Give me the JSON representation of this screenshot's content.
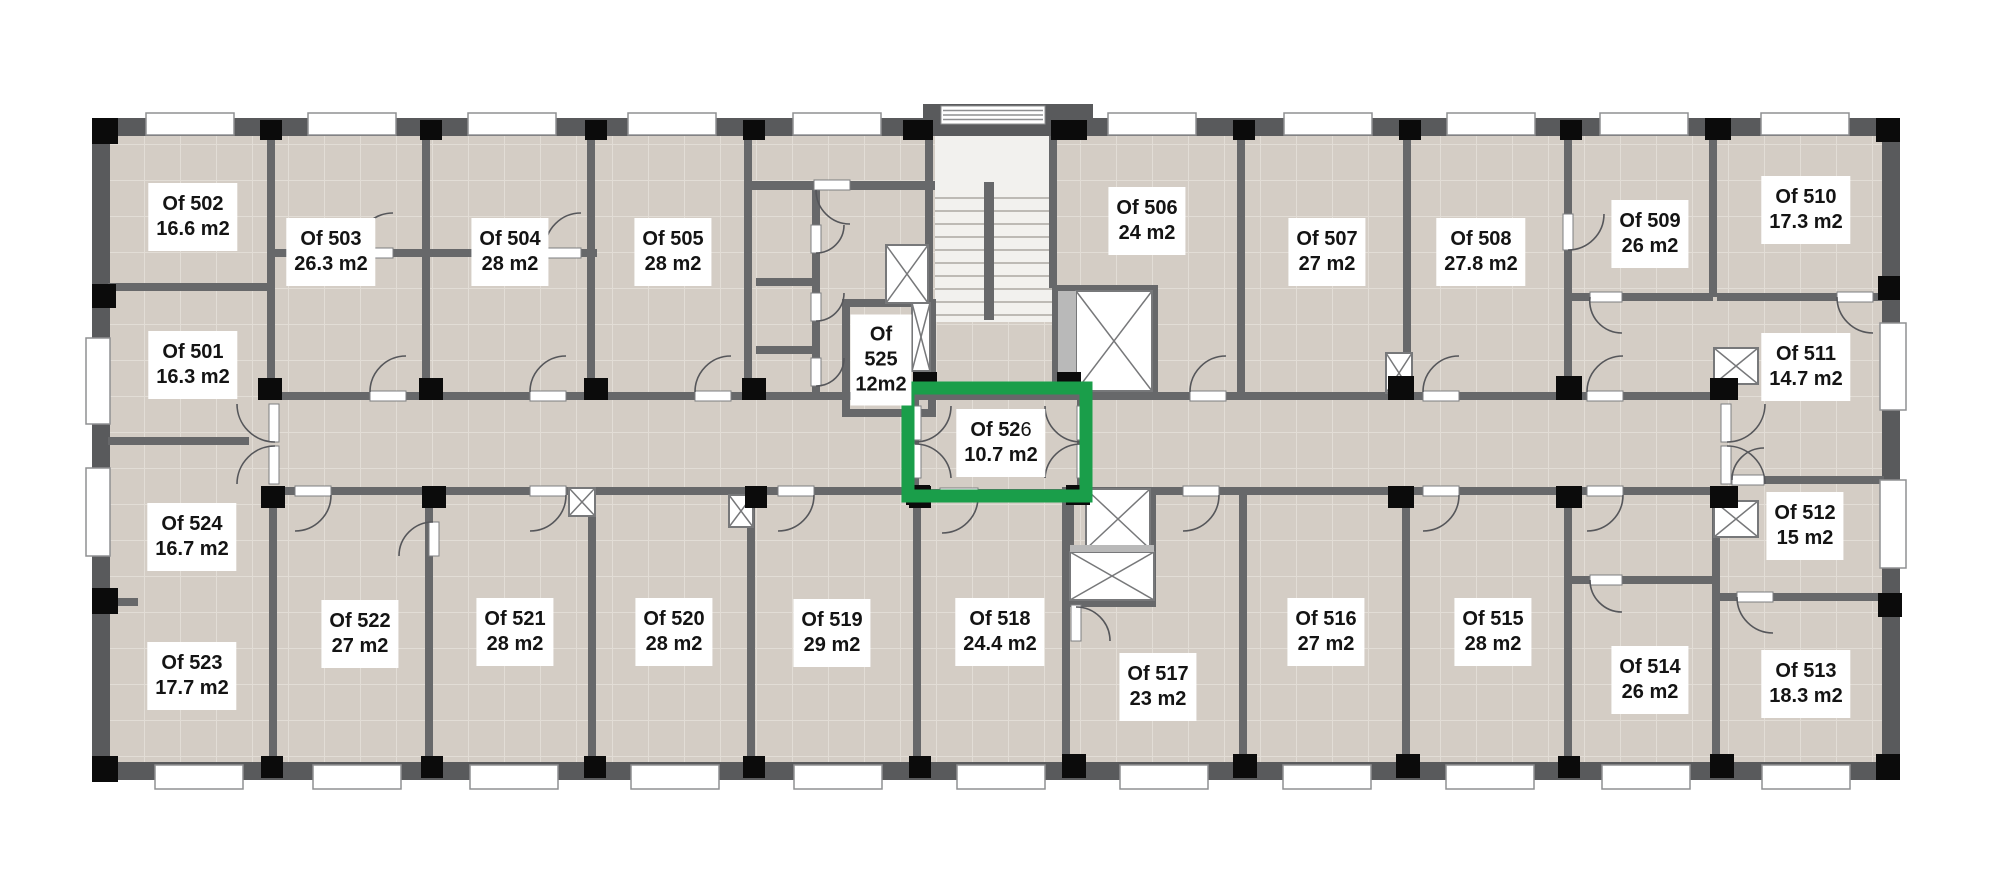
{
  "plan_title": "office-floor-plan",
  "colors": {
    "page_bg": "#ffffff",
    "floor_base": "#d4cdc5",
    "floor_grout": "#e2ddd6",
    "wall": "#67686a",
    "wall_dark": "#595a5c",
    "column": "#0b0b0b",
    "window_fill": "#ffffff",
    "window_border": "#8f9092",
    "door_arc": "#55565a",
    "leaf_border": "#7d7e80",
    "shaft_fill": "#ffffff",
    "shaft_border": "#77787a",
    "elevator_band": "#b9b9b9",
    "marble": "#f2f1ee",
    "step_line": "#bdbab5",
    "highlight_green": "#1a9e4a",
    "label_bg": "#ffffff",
    "label_text": "#141414"
  },
  "rooms": [
    {
      "id": "501",
      "label": "Of 501",
      "area": "16.3 m2",
      "cx": 193,
      "cy": 365
    },
    {
      "id": "502",
      "label": "Of 502",
      "area": "16.6 m2",
      "cx": 193,
      "cy": 217
    },
    {
      "id": "503",
      "label": "Of 503",
      "area": "26.3 m2",
      "cx": 331,
      "cy": 252
    },
    {
      "id": "504",
      "label": "Of 504",
      "area": "28 m2",
      "cx": 510,
      "cy": 252
    },
    {
      "id": "505",
      "label": "Of 505",
      "area": "28 m2",
      "cx": 673,
      "cy": 252
    },
    {
      "id": "506",
      "label": "Of 506",
      "area": "24 m2",
      "cx": 1147,
      "cy": 221
    },
    {
      "id": "507",
      "label": "Of 507",
      "area": "27 m2",
      "cx": 1327,
      "cy": 252
    },
    {
      "id": "508",
      "label": "Of 508",
      "area": "27.8 m2",
      "cx": 1481,
      "cy": 252
    },
    {
      "id": "509",
      "label": "Of 509",
      "area": "26 m2",
      "cx": 1650,
      "cy": 234
    },
    {
      "id": "510",
      "label": "Of 510",
      "area": "17.3 m2",
      "cx": 1806,
      "cy": 210
    },
    {
      "id": "511",
      "label": "Of 511",
      "area": "14.7 m2",
      "cx": 1806,
      "cy": 367
    },
    {
      "id": "512",
      "label": "Of 512",
      "area": "15 m2",
      "cx": 1805,
      "cy": 526
    },
    {
      "id": "513",
      "label": "Of 513",
      "area": "18.3 m2",
      "cx": 1806,
      "cy": 684
    },
    {
      "id": "514",
      "label": "Of 514",
      "area": "26 m2",
      "cx": 1650,
      "cy": 680
    },
    {
      "id": "515",
      "label": "Of 515",
      "area": "28 m2",
      "cx": 1493,
      "cy": 632
    },
    {
      "id": "516",
      "label": "Of 516",
      "area": "27 m2",
      "cx": 1326,
      "cy": 632
    },
    {
      "id": "517",
      "label": "Of 517",
      "area": "23 m2",
      "cx": 1158,
      "cy": 687
    },
    {
      "id": "518",
      "label": "Of 518",
      "area": "24.4 m2",
      "cx": 1000,
      "cy": 632
    },
    {
      "id": "519",
      "label": "Of 519",
      "area": "29 m2",
      "cx": 832,
      "cy": 633
    },
    {
      "id": "520",
      "label": "Of 520",
      "area": "28 m2",
      "cx": 674,
      "cy": 632
    },
    {
      "id": "521",
      "label": "Of 521",
      "area": "28 m2",
      "cx": 515,
      "cy": 632
    },
    {
      "id": "522",
      "label": "Of 522",
      "area": "27 m2",
      "cx": 360,
      "cy": 634
    },
    {
      "id": "523",
      "label": "Of 523",
      "area": "17.7 m2",
      "cx": 192,
      "cy": 676
    },
    {
      "id": "524",
      "label": "Of 524",
      "area": "16.7 m2",
      "cx": 192,
      "cy": 537
    },
    {
      "id": "525",
      "stacked": [
        "Of",
        "525",
        "12m2"
      ],
      "cx": 881,
      "cy": 360
    },
    {
      "id": "526",
      "label_bold": "Of 52",
      "label_tail": "6",
      "area": "10.7 m2",
      "cx": 1001,
      "cy": 443,
      "highlighted": true
    }
  ],
  "highlight": {
    "room_id": "526",
    "frame": [
      908,
      388,
      178,
      108
    ],
    "stroke_width": 13,
    "color": "#1a9e4a"
  },
  "geometry": {
    "floor": [
      110,
      136,
      1772,
      628
    ],
    "tile_size": 36,
    "exterior_walls": [
      [
        92,
        118,
        1808,
        18
      ],
      [
        92,
        762,
        1808,
        18
      ],
      [
        92,
        118,
        18,
        662
      ],
      [
        1882,
        118,
        18,
        662
      ],
      [
        923,
        104,
        170,
        22
      ]
    ],
    "interior_walls": [
      [
        267,
        136,
        8,
        260
      ],
      [
        422,
        136,
        8,
        260
      ],
      [
        587,
        136,
        8,
        260
      ],
      [
        744,
        136,
        8,
        260
      ],
      [
        925,
        136,
        8,
        172
      ],
      [
        1049,
        136,
        8,
        152
      ],
      [
        1237,
        136,
        8,
        260
      ],
      [
        1403,
        136,
        8,
        260
      ],
      [
        1564,
        136,
        8,
        260
      ],
      [
        1709,
        136,
        8,
        161
      ],
      [
        269,
        487,
        8,
        275
      ],
      [
        425,
        487,
        8,
        275
      ],
      [
        588,
        487,
        8,
        275
      ],
      [
        747,
        487,
        8,
        275
      ],
      [
        913,
        487,
        8,
        275
      ],
      [
        1062,
        487,
        8,
        275
      ],
      [
        1239,
        487,
        8,
        275
      ],
      [
        1402,
        487,
        8,
        275
      ],
      [
        1564,
        487,
        8,
        275
      ],
      [
        1712,
        487,
        8,
        275
      ],
      [
        108,
        283,
        163,
        8
      ],
      [
        108,
        437,
        141,
        8
      ],
      [
        108,
        598,
        30,
        8
      ],
      [
        275,
        249,
        322,
        8
      ],
      [
        275,
        392,
        636,
        8
      ],
      [
        1085,
        392,
        645,
        8
      ],
      [
        275,
        487,
        636,
        8
      ],
      [
        1085,
        487,
        645,
        8
      ],
      [
        1572,
        293,
        141,
        8
      ],
      [
        1717,
        293,
        167,
        8
      ],
      [
        752,
        181,
        64,
        9
      ],
      [
        850,
        181,
        85,
        9
      ],
      [
        756,
        278,
        60,
        8
      ],
      [
        756,
        346,
        60,
        8
      ],
      [
        812,
        190,
        8,
        210
      ],
      [
        842,
        299,
        8,
        118
      ],
      [
        842,
        299,
        88,
        8
      ],
      [
        842,
        409,
        88,
        8
      ],
      [
        928,
        299,
        8,
        118
      ],
      [
        911,
        392,
        174,
        8
      ],
      [
        911,
        392,
        8,
        105
      ],
      [
        1077,
        392,
        8,
        105
      ],
      [
        911,
        489,
        174,
        8
      ],
      [
        1572,
        576,
        148,
        8
      ],
      [
        1726,
        476,
        158,
        8
      ],
      [
        1720,
        593,
        164,
        8
      ],
      [
        1052,
        285,
        106,
        8
      ],
      [
        1052,
        285,
        8,
        114
      ],
      [
        1150,
        285,
        8,
        114
      ],
      [
        1066,
        487,
        8,
        120
      ],
      [
        1148,
        487,
        8,
        120
      ],
      [
        1066,
        599,
        90,
        8
      ]
    ],
    "door_leaves": [
      [
        370,
        391,
        36,
        10
      ],
      [
        530,
        391,
        36,
        10
      ],
      [
        695,
        391,
        36,
        10
      ],
      [
        1190,
        391,
        36,
        10
      ],
      [
        1423,
        391,
        36,
        10
      ],
      [
        1587,
        391,
        36,
        10
      ],
      [
        295,
        486,
        36,
        10
      ],
      [
        530,
        486,
        36,
        10
      ],
      [
        778,
        486,
        36,
        10
      ],
      [
        1183,
        486,
        36,
        10
      ],
      [
        1423,
        486,
        36,
        10
      ],
      [
        1587,
        486,
        36,
        10
      ],
      [
        357,
        248,
        36,
        10
      ],
      [
        545,
        248,
        36,
        10
      ],
      [
        269,
        404,
        10,
        38
      ],
      [
        269,
        446,
        10,
        38
      ],
      [
        1721,
        404,
        10,
        38
      ],
      [
        1721,
        446,
        10,
        38
      ],
      [
        911,
        406,
        10,
        34
      ],
      [
        911,
        444,
        10,
        34
      ],
      [
        1077,
        406,
        10,
        34
      ],
      [
        1077,
        444,
        10,
        34
      ],
      [
        940,
        488,
        38,
        10
      ],
      [
        1563,
        214,
        10,
        36
      ],
      [
        1590,
        292,
        32,
        10
      ],
      [
        1837,
        292,
        36,
        10
      ],
      [
        1590,
        575,
        32,
        10
      ],
      [
        1737,
        592,
        36,
        10
      ],
      [
        1732,
        475,
        32,
        10
      ],
      [
        811,
        225,
        10,
        28
      ],
      [
        811,
        293,
        10,
        28
      ],
      [
        811,
        358,
        10,
        28
      ],
      [
        814,
        180,
        36,
        10
      ],
      [
        1071,
        605,
        10,
        36
      ],
      [
        429,
        522,
        10,
        34
      ]
    ],
    "door_arcs": [
      "M 370 392 A 36 36 0 0 1 406 356",
      "M 530 392 A 36 36 0 0 1 566 356",
      "M 695 392 A 36 36 0 0 1 731 356",
      "M 1190 392 A 36 36 0 0 1 1226 356",
      "M 1423 392 A 36 36 0 0 1 1459 356",
      "M 1587 392 A 36 36 0 0 1 1623 356",
      "M 331 495 A 36 36 0 0 1 295 531",
      "M 566 495 A 36 36 0 0 1 530 531",
      "M 814 495 A 36 36 0 0 1 778 531",
      "M 1219 495 A 36 36 0 0 1 1183 531",
      "M 1459 495 A 36 36 0 0 1 1423 531",
      "M 1623 495 A 36 36 0 0 1 1587 531",
      "M 357 249 A 36 36 0 0 1 393 213",
      "M 545 249 A 36 36 0 0 1 581 213",
      "M 275 442 A 38 38 0 0 1 237 404",
      "M 275 446 A 38 38 0 0 0 237 484",
      "M 1727 442 A 38 38 0 0 0 1765 404",
      "M 1727 446 A 38 38 0 0 1 1765 484",
      "M 915 442 A 36 36 0 0 0 951 406",
      "M 915 444 A 36 36 0 0 1 951 478",
      "M 1081 442 A 36 36 0 0 1 1045 406",
      "M 1081 444 A 36 36 0 0 0 1045 478",
      "M 1568 250 A 36 36 0 0 0 1604 214",
      "M 1590 297 A 32 32 0 0 0 1622 333",
      "M 1837 297 A 36 36 0 0 0 1873 333",
      "M 1590 580 A 32 32 0 0 0 1622 612",
      "M 1737 597 A 36 36 0 0 0 1773 633",
      "M 1732 480 A 32 32 0 0 1 1764 448",
      "M 816 253 A 28 28 0 0 0 844 225",
      "M 816 321 A 28 28 0 0 0 844 293",
      "M 816 386 A 28 28 0 0 0 844 358",
      "M 816 190 A 34 34 0 0 0 850 224",
      "M 1076 607 A 34 34 0 0 1 1110 641",
      "M 433 522 A 34 34 0 0 0 399 556",
      "M 978 497 A 36 36 0 0 1 942 533"
    ],
    "columns": [
      [
        92,
        118,
        26,
        26
      ],
      [
        260,
        120,
        22,
        20
      ],
      [
        420,
        120,
        22,
        20
      ],
      [
        585,
        120,
        22,
        20
      ],
      [
        743,
        120,
        22,
        20
      ],
      [
        903,
        120,
        30,
        20
      ],
      [
        1051,
        120,
        36,
        20
      ],
      [
        1233,
        120,
        22,
        20
      ],
      [
        1399,
        120,
        22,
        20
      ],
      [
        1560,
        120,
        22,
        20
      ],
      [
        1705,
        118,
        26,
        22
      ],
      [
        1876,
        118,
        24,
        24
      ],
      [
        92,
        756,
        26,
        26
      ],
      [
        261,
        756,
        22,
        22
      ],
      [
        421,
        756,
        22,
        22
      ],
      [
        584,
        756,
        22,
        22
      ],
      [
        743,
        756,
        22,
        22
      ],
      [
        909,
        756,
        22,
        22
      ],
      [
        1062,
        754,
        24,
        24
      ],
      [
        1233,
        754,
        24,
        24
      ],
      [
        1396,
        754,
        24,
        24
      ],
      [
        1558,
        756,
        22,
        22
      ],
      [
        1710,
        754,
        24,
        24
      ],
      [
        1876,
        754,
        24,
        26
      ],
      [
        92,
        284,
        24,
        24
      ],
      [
        92,
        588,
        26,
        26
      ],
      [
        1878,
        276,
        22,
        24
      ],
      [
        1878,
        593,
        24,
        24
      ],
      [
        258,
        378,
        24,
        22
      ],
      [
        419,
        378,
        24,
        22
      ],
      [
        584,
        378,
        24,
        22
      ],
      [
        742,
        378,
        24,
        22
      ],
      [
        1388,
        376,
        26,
        24
      ],
      [
        1556,
        376,
        26,
        24
      ],
      [
        1710,
        378,
        28,
        22
      ],
      [
        261,
        486,
        24,
        22
      ],
      [
        422,
        486,
        24,
        22
      ],
      [
        745,
        486,
        22,
        22
      ],
      [
        909,
        486,
        22,
        22
      ],
      [
        1388,
        486,
        26,
        22
      ],
      [
        1556,
        486,
        26,
        22
      ],
      [
        1710,
        486,
        28,
        22
      ],
      [
        913,
        372,
        24,
        22
      ],
      [
        1057,
        372,
        24,
        22
      ],
      [
        906,
        485,
        24,
        20
      ],
      [
        1066,
        485,
        24,
        20
      ]
    ],
    "windows_top_x": [
      146,
      308,
      468,
      628,
      793,
      1108,
      1284,
      1447,
      1600,
      1761
    ],
    "windows_top_band": [
      113,
      88,
      22
    ],
    "windows_bottom_x": [
      155,
      313,
      470,
      631,
      794,
      957,
      1120,
      1283,
      1446,
      1602,
      1762
    ],
    "windows_bottom_band": [
      765,
      88,
      24
    ],
    "windows_side": [
      [
        86,
        338,
        24,
        86
      ],
      [
        86,
        468,
        24,
        88
      ],
      [
        1880,
        323,
        26,
        87
      ],
      [
        1880,
        480,
        26,
        88
      ]
    ],
    "shafts": [
      [
        886,
        245,
        42,
        58
      ],
      [
        912,
        303,
        18,
        68
      ],
      [
        1076,
        291,
        76,
        100
      ],
      [
        1086,
        489,
        64,
        60
      ],
      [
        1070,
        552,
        84,
        48
      ],
      [
        1386,
        353,
        26,
        40
      ],
      [
        1714,
        501,
        44,
        36
      ],
      [
        1714,
        348,
        44,
        36
      ],
      [
        569,
        488,
        26,
        28
      ],
      [
        729,
        495,
        24,
        32
      ]
    ],
    "elevator_bands": [
      [
        1058,
        291,
        18,
        100
      ],
      [
        1070,
        545,
        84,
        7
      ]
    ],
    "stairs": {
      "marble": [
        935,
        136,
        118,
        186
      ],
      "steps_x": [
        935,
        1053
      ],
      "steps_y_start": 198,
      "steps_y_end": 318,
      "steps_gap": 13,
      "rail": [
        984,
        182,
        10,
        138
      ],
      "bump_window": [
        941,
        106,
        104,
        18
      ]
    }
  }
}
